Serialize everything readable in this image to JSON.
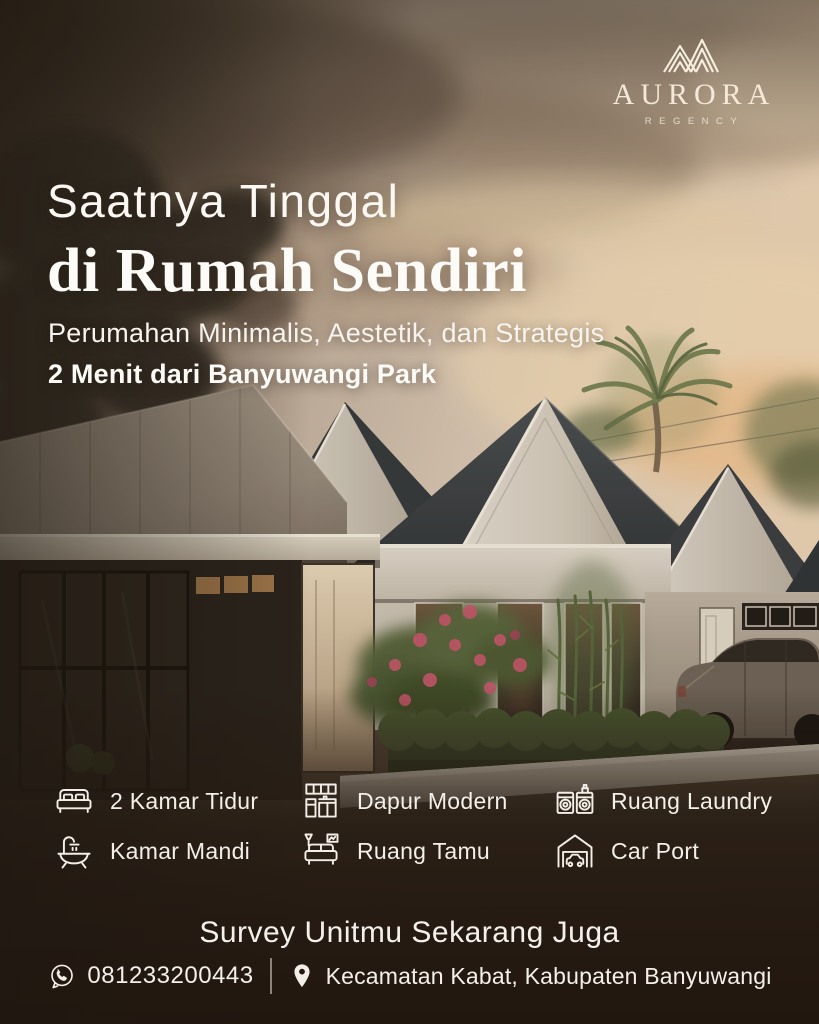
{
  "logo": {
    "brand": "AURORA",
    "sub_brand": "REGENCY",
    "icon": "mountain-peaks-icon"
  },
  "headline": {
    "line1": "Saatnya Tinggal",
    "line2": "di Rumah Sendiri"
  },
  "tagline": {
    "line1": "Perumahan Minimalis, Aestetik, dan Strategis",
    "line2": "2 Menit dari Banyuwangi Park"
  },
  "features": [
    {
      "icon": "bed-icon",
      "label": "2 Kamar Tidur"
    },
    {
      "icon": "bathtub-icon",
      "label": "Kamar Mandi"
    },
    {
      "icon": "kitchen-icon",
      "label": "Dapur Modern"
    },
    {
      "icon": "sofa-icon",
      "label": "Ruang Tamu"
    },
    {
      "icon": "laundry-icon",
      "label": "Ruang Laundry"
    },
    {
      "icon": "garage-icon",
      "label": "Car Port"
    }
  ],
  "cta": {
    "text": "Survey Unitmu Sekarang Juga"
  },
  "contact": {
    "phone_icon": "whatsapp-icon",
    "phone": "081233200443",
    "location_icon": "location-pin-icon",
    "location": "Kecamatan Kabat, Kabupaten Banyuwangi"
  },
  "scene_alt": "Modern minimalist gable-roof housing complex at sunset with palm tree, hedge and parked SUV",
  "colors": {
    "text": "#faf6f0",
    "overlay_brown": "#241a13",
    "sky_peach": "#e4cdb2",
    "roof_dark": "#3b3f42",
    "wall_cream": "#d6cfc5",
    "hedge_green": "#46532f",
    "flower_red": "#c2556a"
  }
}
